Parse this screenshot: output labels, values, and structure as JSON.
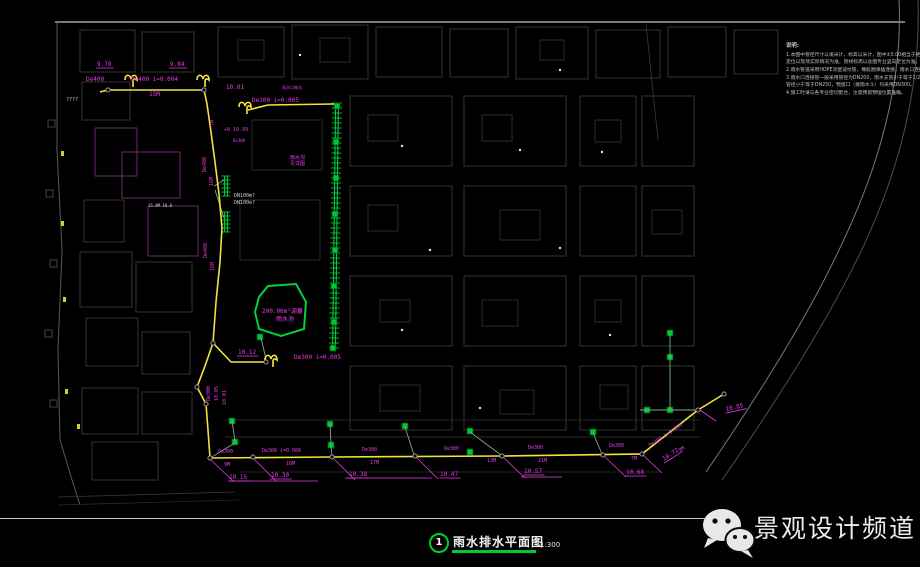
{
  "title_block": {
    "figure_number": "1",
    "title": "雨水排水平面图",
    "scale": "1:300"
  },
  "watermark": {
    "brand": "景观设计频道",
    "icon": "wechat-icon"
  },
  "notes": {
    "heading": "说明:",
    "lines": [
      "1.本图中管径尺寸以毫米计，标高以米计，图中±0.00相当于绝对标高详见一览表，具体",
      "  定位以现场实际情况为准，管线标高以总图专业竖向定位为准。",
      "2.雨水管道采用HDPE双壁波纹管，橡胶圈承插连接，雨水口连接管坡度不小于1%。",
      "3.雨水口连接管一般采用管径为DN200，雨水支管小于等于1/2，",
      "  管径小于等于DN250，预留口（接雨水斗）均采用DN300。",
      "4.施工时请与各专业密切配合，注意预留预埋位置准确。"
    ]
  },
  "colors": {
    "m": "#e83ce8",
    "y": "#f0e43c",
    "g": "#00d23c",
    "w": "#cfcfcf"
  },
  "plan": {
    "labels": [
      {
        "t": "9.78",
        "x": 97,
        "y": 66,
        "c": "m",
        "u": 1
      },
      {
        "t": "9.84",
        "x": 170,
        "y": 66,
        "c": "m",
        "u": 1
      },
      {
        "t": "De400",
        "x": 86,
        "y": 81,
        "c": "m"
      },
      {
        "t": "De400  i=0.004",
        "x": 131,
        "y": 81,
        "c": "m"
      },
      {
        "t": "15M",
        "x": 149,
        "y": 96,
        "c": "m"
      },
      {
        "t": "????",
        "x": 66,
        "y": 101,
        "c": "w",
        "s": 5
      },
      {
        "t": "10.01",
        "x": 226,
        "y": 89,
        "c": "m"
      },
      {
        "t": "雨水口做法",
        "x": 282,
        "y": 89,
        "c": "m",
        "s": 4
      },
      {
        "t": "De300  i=0.005",
        "x": 252,
        "y": 102,
        "c": "m"
      },
      {
        "t": "7M",
        "x": 214,
        "y": 126,
        "c": "m",
        "s": 5,
        "r": -90
      },
      {
        "t": "+8 19.99",
        "x": 224,
        "y": 131,
        "c": "m",
        "s": 5
      },
      {
        "t": "De300",
        "x": 233,
        "y": 142,
        "c": "m",
        "s": 4
      },
      {
        "t": "De400",
        "x": 206,
        "y": 172,
        "c": "m",
        "s": 5,
        "r": -90
      },
      {
        "t": "16M",
        "x": 213,
        "y": 186,
        "c": "m",
        "s": 5,
        "r": -90
      },
      {
        "t": "15.8M 18.0",
        "x": 148,
        "y": 207,
        "c": "w",
        "s": 4
      },
      {
        "t": "DN100m?",
        "x": 234,
        "y": 197,
        "c": "w",
        "s": 5
      },
      {
        "t": "DN100e?",
        "x": 234,
        "y": 204,
        "c": "w",
        "s": 5
      },
      {
        "t": "雨水沟",
        "x": 290,
        "y": 159,
        "c": "m",
        "s": 5
      },
      {
        "t": "见详图",
        "x": 290,
        "y": 165,
        "c": "m",
        "s": 5
      },
      {
        "t": "De400",
        "x": 207,
        "y": 258,
        "c": "m",
        "s": 5,
        "r": -90
      },
      {
        "t": "16M",
        "x": 214,
        "y": 271,
        "c": "m",
        "s": 5,
        "r": -90
      },
      {
        "t": "200.00m³调蓄",
        "x": 262,
        "y": 313,
        "c": "m",
        "s": 6
      },
      {
        "t": "雨水池",
        "x": 276,
        "y": 321,
        "c": "m",
        "s": 6
      },
      {
        "t": "10.12",
        "x": 238,
        "y": 354,
        "c": "m",
        "u": 1
      },
      {
        "t": "De300  i=0.005",
        "x": 294,
        "y": 359,
        "c": "m"
      },
      {
        "t": "De300",
        "x": 210,
        "y": 401,
        "c": "m",
        "s": 5,
        "r": -90
      },
      {
        "t": "10.05",
        "x": 218,
        "y": 401,
        "c": "m",
        "s": 5,
        "r": -90
      },
      {
        "t": "10.01",
        "x": 226,
        "y": 405,
        "c": "m",
        "s": 5,
        "r": -90
      },
      {
        "t": "De300",
        "x": 218,
        "y": 453,
        "c": "m",
        "s": 5
      },
      {
        "t": "9M",
        "x": 224,
        "y": 466,
        "c": "m",
        "s": 5
      },
      {
        "t": "10.15",
        "x": 229,
        "y": 479,
        "c": "m",
        "u": 1
      },
      {
        "t": "De300  i=0.006",
        "x": 262,
        "y": 452,
        "c": "m",
        "s": 5
      },
      {
        "t": "16M",
        "x": 286,
        "y": 465,
        "c": "m",
        "s": 5
      },
      {
        "t": "10.30",
        "x": 271,
        "y": 477,
        "c": "m",
        "u": 1
      },
      {
        "t": "De300",
        "x": 362,
        "y": 451,
        "c": "m",
        "s": 5
      },
      {
        "t": "17M",
        "x": 370,
        "y": 464,
        "c": "m",
        "s": 5
      },
      {
        "t": "10.38",
        "x": 349,
        "y": 476,
        "c": "m",
        "u": 1
      },
      {
        "t": "De300",
        "x": 444,
        "y": 450,
        "c": "m",
        "s": 5
      },
      {
        "t": "13M",
        "x": 487,
        "y": 462,
        "c": "m",
        "s": 5
      },
      {
        "t": "10.47",
        "x": 440,
        "y": 476,
        "c": "m",
        "u": 1
      },
      {
        "t": "De300",
        "x": 528,
        "y": 449,
        "c": "m",
        "s": 5
      },
      {
        "t": "21M",
        "x": 538,
        "y": 462,
        "c": "m",
        "s": 5
      },
      {
        "t": "10.57",
        "x": 524,
        "y": 473,
        "c": "m",
        "u": 1
      },
      {
        "t": "De300",
        "x": 609,
        "y": 447,
        "c": "m",
        "s": 5
      },
      {
        "t": "7M",
        "x": 631,
        "y": 460,
        "c": "m",
        "s": 5
      },
      {
        "t": "10.68",
        "x": 626,
        "y": 474,
        "c": "m",
        "u": 1
      },
      {
        "t": "De300 i=0.005",
        "x": 650,
        "y": 447,
        "c": "m",
        "s": 5,
        "r": -33
      },
      {
        "t": "9M",
        "x": 680,
        "y": 452,
        "c": "m",
        "s": 5,
        "r": -33
      },
      {
        "t": "10.72",
        "x": 664,
        "y": 461,
        "c": "m",
        "r": -33,
        "u": 1
      },
      {
        "t": "10.85",
        "x": 726,
        "y": 411,
        "c": "m",
        "r": -12,
        "u": 1
      }
    ],
    "pipes": [
      [
        [
          100,
          92
        ],
        [
          108,
          90
        ],
        [
          204,
          90
        ]
      ],
      [
        [
          204,
          90
        ],
        [
          207,
          104
        ],
        [
          211,
          132
        ],
        [
          215,
          162
        ],
        [
          219,
          194
        ],
        [
          222,
          228
        ],
        [
          220,
          262
        ],
        [
          216,
          302
        ],
        [
          213,
          343
        ]
      ],
      [
        [
          213,
          343
        ],
        [
          231,
          362
        ],
        [
          266,
          362
        ]
      ],
      [
        [
          213,
          343
        ],
        [
          205,
          366
        ],
        [
          197,
          387
        ]
      ],
      [
        [
          197,
          387
        ],
        [
          206,
          404
        ],
        [
          208,
          430
        ],
        [
          210,
          458
        ]
      ],
      [
        [
          210,
          458
        ],
        [
          332,
          457
        ],
        [
          502,
          456
        ],
        [
          642,
          454
        ]
      ],
      [
        [
          642,
          454
        ],
        [
          698,
          410
        ],
        [
          724,
          394
        ]
      ],
      [
        [
          248,
          110
        ],
        [
          268,
          105
        ],
        [
          334,
          104
        ]
      ]
    ],
    "links": [
      [
        [
          210,
          458
        ],
        [
          235,
          443
        ]
      ],
      [
        [
          232,
          421
        ],
        [
          235,
          441
        ]
      ],
      [
        [
          330,
          424
        ],
        [
          331,
          444
        ]
      ],
      [
        [
          331,
          446
        ],
        [
          332,
          456
        ]
      ],
      [
        [
          405,
          427
        ],
        [
          414,
          455
        ]
      ],
      [
        [
          470,
          432
        ],
        [
          501,
          455
        ]
      ],
      [
        [
          593,
          433
        ],
        [
          602,
          454
        ]
      ],
      [
        [
          640,
          410
        ],
        [
          697,
          410
        ]
      ],
      [
        [
          670,
          334
        ],
        [
          670,
          409
        ]
      ],
      [
        [
          214,
          186
        ],
        [
          224,
          180
        ]
      ],
      [
        [
          215,
          190
        ],
        [
          224,
          218
        ]
      ],
      [
        [
          261,
          338
        ],
        [
          266,
          359
        ]
      ]
    ],
    "leaders": [
      [
        [
          211,
          460
        ],
        [
          233,
          481
        ]
      ],
      [
        [
          254,
          459
        ],
        [
          276,
          481
        ]
      ],
      [
        [
          333,
          458
        ],
        [
          355,
          480
        ]
      ],
      [
        [
          416,
          457
        ],
        [
          438,
          479
        ]
      ],
      [
        [
          503,
          457
        ],
        [
          525,
          478
        ]
      ],
      [
        [
          604,
          456
        ],
        [
          626,
          477
        ]
      ],
      [
        [
          643,
          455
        ],
        [
          662,
          473
        ]
      ],
      [
        [
          700,
          410
        ],
        [
          716,
          421
        ]
      ]
    ],
    "long_underlines": [
      [
        229,
        481,
        318,
        481
      ],
      [
        345,
        478,
        432,
        478
      ],
      [
        521,
        477,
        562,
        477
      ]
    ],
    "nodes": [
      [
        108,
        90
      ],
      [
        204,
        90
      ],
      [
        213,
        343
      ],
      [
        197,
        387
      ],
      [
        206,
        404
      ],
      [
        210,
        458
      ],
      [
        253,
        457
      ],
      [
        332,
        457
      ],
      [
        415,
        456
      ],
      [
        502,
        456
      ],
      [
        603,
        455
      ],
      [
        642,
        454
      ],
      [
        698,
        410
      ],
      [
        724,
        394
      ],
      [
        266,
        362
      ]
    ],
    "drain_symbols": [
      [
        131,
        78
      ],
      [
        203,
        78
      ],
      [
        245,
        105
      ],
      [
        271,
        358
      ]
    ],
    "inlets": [
      [
        337,
        106
      ],
      [
        336,
        142
      ],
      [
        336,
        178
      ],
      [
        335,
        214
      ],
      [
        335,
        250
      ],
      [
        334,
        286
      ],
      [
        334,
        322
      ],
      [
        333,
        348
      ],
      [
        260,
        337
      ],
      [
        232,
        421
      ],
      [
        235,
        442
      ],
      [
        330,
        424
      ],
      [
        331,
        445
      ],
      [
        405,
        426
      ],
      [
        470,
        431
      ],
      [
        470,
        452
      ],
      [
        593,
        432
      ],
      [
        647,
        410
      ],
      [
        670,
        410
      ],
      [
        670,
        357
      ],
      [
        670,
        333
      ]
    ],
    "channels": [
      {
        "x1": 337,
        "y1": 103,
        "x2": 334,
        "y2": 350,
        "tick": 10,
        "step": 5
      },
      {
        "x1": 226,
        "y1": 176,
        "x2": 226,
        "y2": 196,
        "tick": 9,
        "step": 4
      },
      {
        "x1": 226,
        "y1": 212,
        "x2": 226,
        "y2": 232,
        "tick": 9,
        "step": 4
      }
    ],
    "pond": [
      [
        268,
        286
      ],
      [
        296,
        284
      ],
      [
        306,
        302
      ],
      [
        304,
        329
      ],
      [
        281,
        336
      ],
      [
        259,
        329
      ],
      [
        255,
        312
      ],
      [
        259,
        297
      ]
    ]
  }
}
